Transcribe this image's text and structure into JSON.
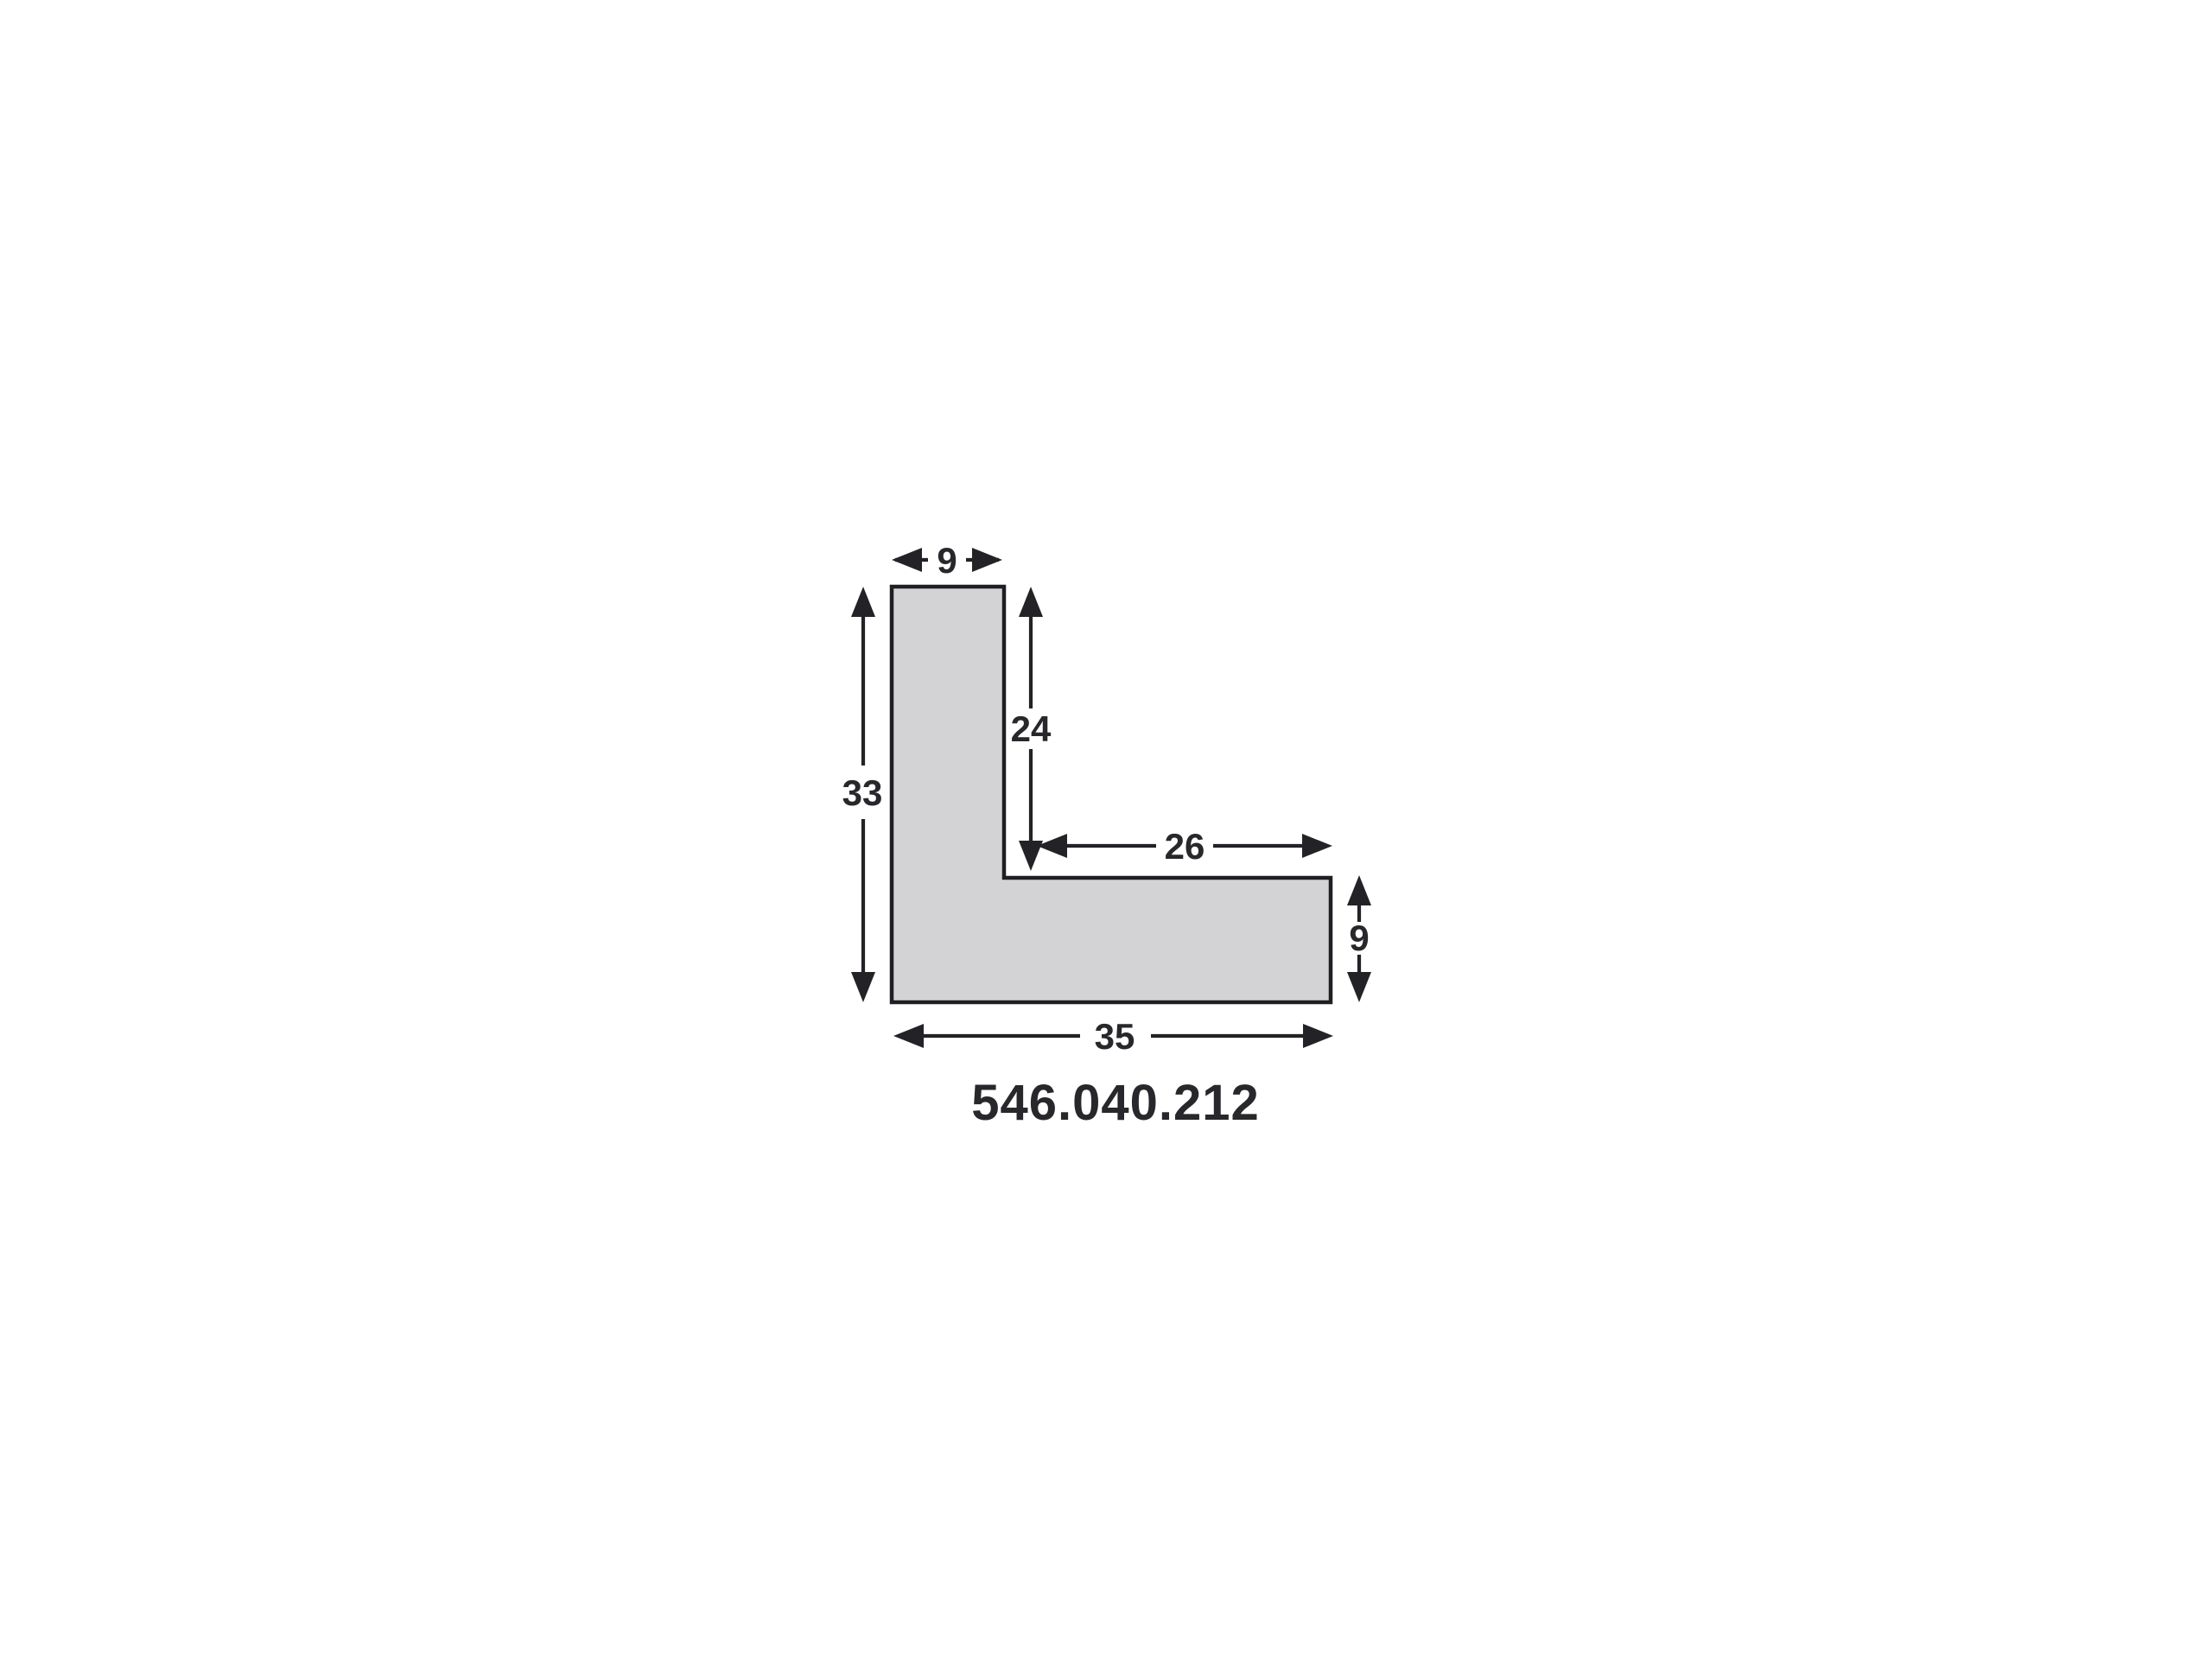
{
  "colors": {
    "background": "#ffffff",
    "shape_fill": "#d3d3d5",
    "outline": "#1f1f23",
    "line": "#232327",
    "text": "#28282c"
  },
  "part_number": "546.040.212",
  "dimensions": {
    "top_width": "9",
    "inner_height": "24",
    "left_height": "33",
    "inner_width": "26",
    "right_height": "9",
    "bottom_width": "35"
  }
}
